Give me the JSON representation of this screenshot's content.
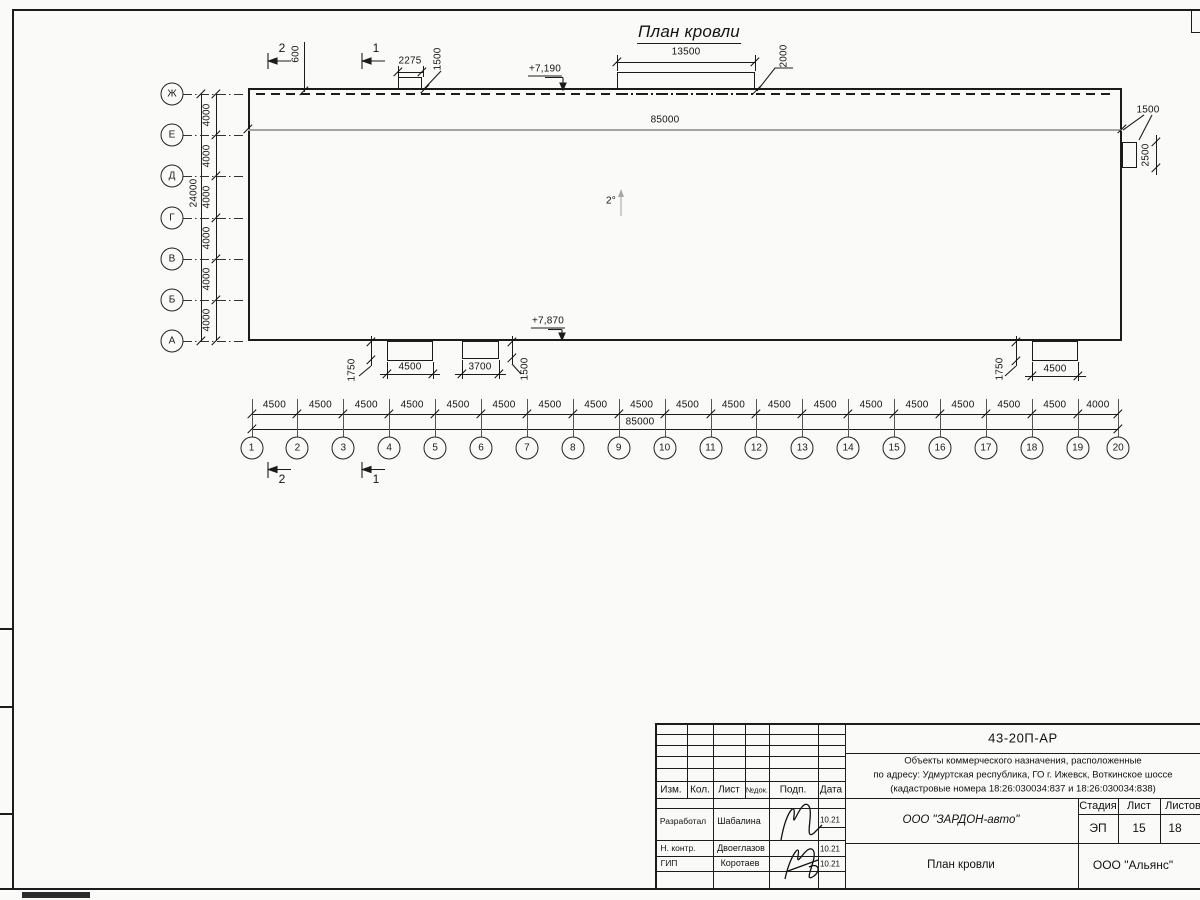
{
  "colors": {
    "line": "#1c1c1c",
    "gray_line": "#a3a3a3",
    "paper": "#fafaf8"
  },
  "plan": {
    "title": "План кровли"
  },
  "annotations": {
    "slope": "2°",
    "level_top": "+7,190",
    "level_bottom": "+7,870"
  },
  "sections": {
    "cut_1": "1",
    "cut_2": "2"
  },
  "dims": {
    "roof_overhang": "600",
    "top_tab_width": "2275",
    "top_tab_offset": "1500",
    "big_tab_width": "13500",
    "big_tab_offset": "2000",
    "inner_total": "85000",
    "right_tab_width": "1500",
    "right_tab_height": "2500",
    "bottom_tab1_width": "4500",
    "bottom_tab1_offset": "1750",
    "bottom_tab2_width": "3700",
    "bottom_tab2_offset": "1500",
    "bottom_tab3_width": "4500",
    "bottom_tab3_offset": "1750",
    "bottom_total": "85000",
    "left_total": "24000"
  },
  "axes": {
    "rows": [
      "Ж",
      "Е",
      "Д",
      "Г",
      "В",
      "Б",
      "А"
    ],
    "row_spacings": [
      "4000",
      "4000",
      "4000",
      "4000",
      "4000",
      "4000"
    ],
    "cols": [
      "1",
      "2",
      "3",
      "4",
      "5",
      "6",
      "7",
      "8",
      "9",
      "10",
      "11",
      "12",
      "13",
      "14",
      "15",
      "16",
      "17",
      "18",
      "19",
      "20"
    ],
    "col_spacings": [
      "4500",
      "4500",
      "4500",
      "4500",
      "4500",
      "4500",
      "4500",
      "4500",
      "4500",
      "4500",
      "4500",
      "4500",
      "4500",
      "4500",
      "4500",
      "4500",
      "4500",
      "4500",
      "4000"
    ]
  },
  "titleblock": {
    "doc_number": "43-20П-АР",
    "project_line1": "Объекты коммерческого назначения, расположенные",
    "project_line2": "по адресу: Удмуртская республика, ГО г. Ижевск, Воткинское шоссе",
    "project_line3": "(кадастровые номера 18:26:030034:837 и 18:26:030034:838)",
    "header": {
      "izm": "Изм.",
      "kol": "Кол.",
      "list": "Лист",
      "ndok": "№док.",
      "podp": "Подп.",
      "data": "Дата"
    },
    "rows": [
      {
        "role": "Разработал",
        "name": "Шабалина",
        "date": "10.21"
      },
      {
        "role": "Н. контр.",
        "name": "Двоеглазов",
        "date": "10.21"
      },
      {
        "role": "ГИП",
        "name": "Коротаев",
        "date": "10.21"
      }
    ],
    "company": "ООО \"ЗАРДОН-авто\"",
    "stage_label": "Стадия",
    "sheet_label": "Лист",
    "sheets_label": "Листов",
    "stage": "ЭП",
    "sheet": "15",
    "sheets": "18",
    "drawing_title": "План кровли",
    "org": "ООО \"Альянс\""
  }
}
